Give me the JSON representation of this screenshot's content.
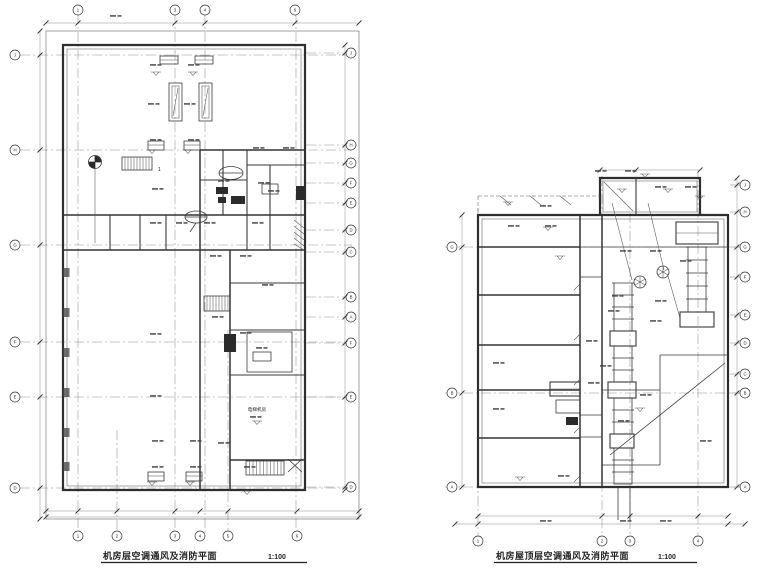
{
  "sheet": {
    "background": "#ffffff",
    "line_color": "#2e2e2e",
    "grid_color": "#8f8f8f"
  },
  "titles": {
    "left": {
      "label": "机房层空调通风及消防平面",
      "scale": "1:100"
    },
    "right": {
      "label": "机房屋顶层空调通风及消防平面",
      "scale": "1:100"
    }
  },
  "left_plan": {
    "labels": {
      "stair": "1",
      "room": "电梯机房"
    },
    "grid": {
      "top": {
        "at": 10,
        "items": [
          {
            "x": 78,
            "label": "1"
          },
          {
            "x": 175,
            "label": "3"
          },
          {
            "x": 205,
            "label": "4"
          },
          {
            "x": 295,
            "label": "6"
          }
        ]
      },
      "bottom": {
        "at": 536,
        "items": [
          {
            "x": 78,
            "label": "1"
          },
          {
            "x": 117,
            "label": "2"
          },
          {
            "x": 175,
            "label": "3"
          },
          {
            "x": 200,
            "label": "4"
          },
          {
            "x": 228,
            "label": "5"
          },
          {
            "x": 297,
            "label": "6"
          }
        ]
      },
      "left": {
        "at": 15,
        "items": [
          {
            "y": 55,
            "label": "J"
          },
          {
            "y": 150,
            "label": "H"
          },
          {
            "y": 245,
            "label": "G"
          },
          {
            "y": 342,
            "label": "F"
          },
          {
            "y": 397,
            "label": "E"
          },
          {
            "y": 488,
            "label": "D"
          }
        ]
      },
      "right": {
        "at": 351,
        "items": [
          {
            "y": 53,
            "label": "J"
          },
          {
            "y": 145,
            "label": "H"
          },
          {
            "y": 163,
            "label": "G"
          },
          {
            "y": 183,
            "label": "F"
          },
          {
            "y": 203,
            "label": "E"
          },
          {
            "y": 230,
            "label": "D"
          },
          {
            "y": 252,
            "label": "C"
          },
          {
            "y": 297,
            "label": "B"
          },
          {
            "y": 317,
            "label": "A"
          },
          {
            "y": 343,
            "label": "F"
          },
          {
            "y": 397,
            "label": "E"
          },
          {
            "y": 487,
            "label": "D"
          }
        ]
      }
    }
  },
  "right_plan": {
    "grid": {
      "bottom": {
        "at": 541,
        "items": [
          {
            "x": 478,
            "label": "1"
          },
          {
            "x": 602,
            "label": "2"
          },
          {
            "x": 630,
            "label": "3"
          },
          {
            "x": 698,
            "label": "4"
          }
        ]
      },
      "left": {
        "at": 452,
        "items": [
          {
            "y": 247,
            "label": "G"
          },
          {
            "y": 393,
            "label": "B"
          },
          {
            "y": 487,
            "label": "A"
          }
        ]
      },
      "right": {
        "at": 745,
        "items": [
          {
            "y": 185,
            "label": "J"
          },
          {
            "y": 212,
            "label": "H"
          },
          {
            "y": 247,
            "label": "G"
          },
          {
            "y": 277,
            "label": "F"
          },
          {
            "y": 315,
            "label": "E"
          },
          {
            "y": 343,
            "label": "D"
          },
          {
            "y": 374,
            "label": "C"
          },
          {
            "y": 393,
            "label": "B"
          },
          {
            "y": 487,
            "label": "A"
          }
        ]
      }
    }
  }
}
